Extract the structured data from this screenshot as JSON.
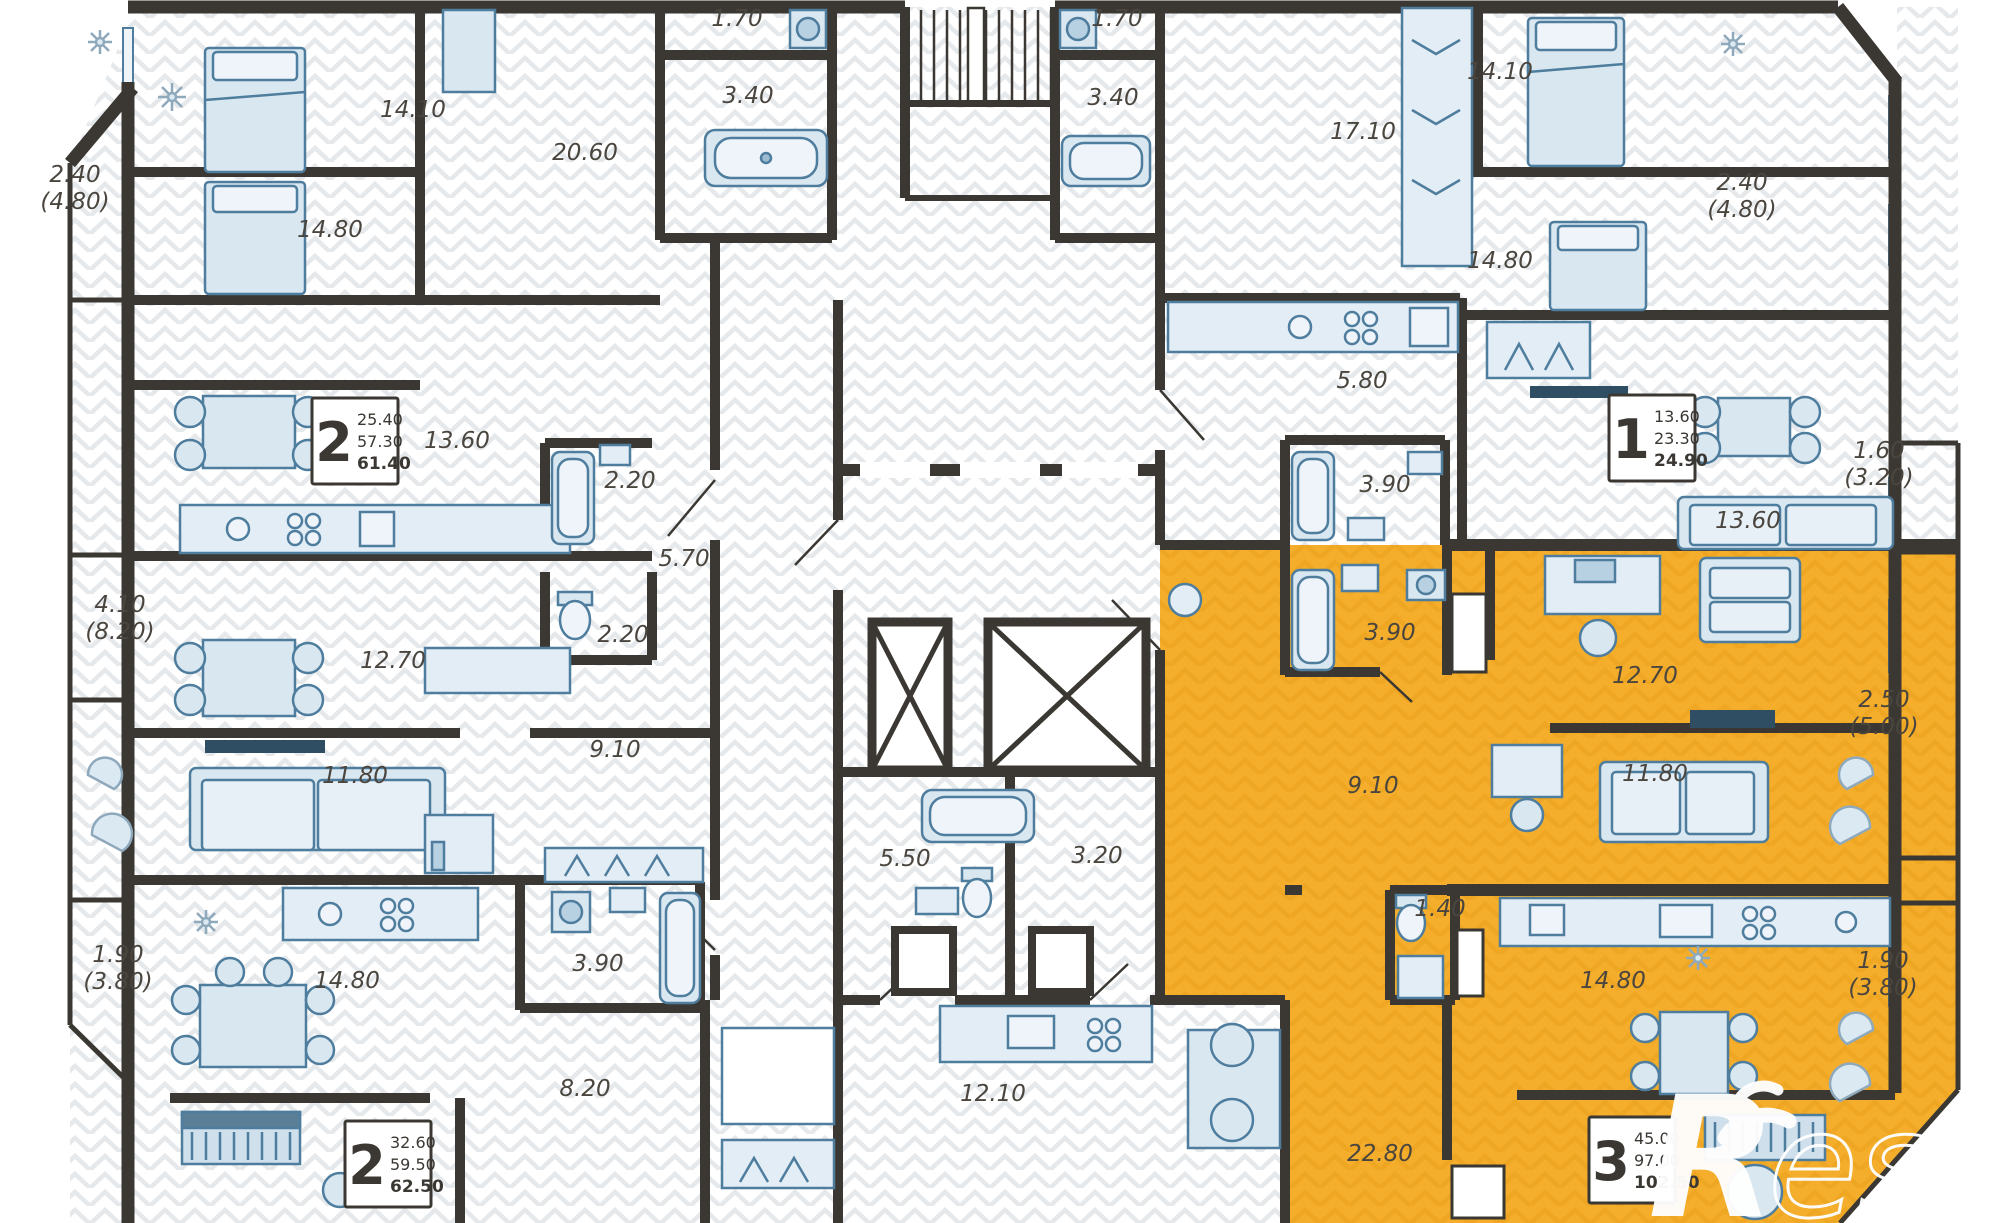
{
  "watermark": {
    "initial": "R",
    "rest": "estate"
  },
  "palette": {
    "wall": "#3b3833",
    "highlight": "#f5ae2b",
    "highlight_hatch": "#e89f1c",
    "hatch": "#e6e9ec",
    "furniture_fill": "#d9e7f1",
    "furniture_stroke": "#4f7d9e",
    "label": "#4a463f"
  },
  "apartments": [
    {
      "rooms": "2",
      "values": [
        "25.40",
        "57.30",
        "61.40"
      ],
      "x": 355,
      "y": 441,
      "highlighted": false
    },
    {
      "rooms": "1",
      "values": [
        "13.60",
        "23.30",
        "24.90"
      ],
      "x": 1652,
      "y": 438,
      "highlighted": false
    },
    {
      "rooms": "2",
      "values": [
        "32.60",
        "59.50",
        "62.50"
      ],
      "x": 388,
      "y": 1164,
      "highlighted": false
    },
    {
      "rooms": "3",
      "values": [
        "45.00",
        "97.00",
        "102.50"
      ],
      "x": 1632,
      "y": 1160,
      "highlighted": true
    }
  ],
  "room_labels": [
    {
      "t": "2.40",
      "s": "(4.80)",
      "x": 75,
      "y": 182
    },
    {
      "t": "14.10",
      "s": "",
      "x": 413,
      "y": 117
    },
    {
      "t": "20.60",
      "s": "",
      "x": 585,
      "y": 160
    },
    {
      "t": "1.70",
      "s": "",
      "x": 737,
      "y": 26
    },
    {
      "t": "3.40",
      "s": "",
      "x": 748,
      "y": 103
    },
    {
      "t": "1.70",
      "s": "",
      "x": 1117,
      "y": 26
    },
    {
      "t": "3.40",
      "s": "",
      "x": 1113,
      "y": 105
    },
    {
      "t": "17.10",
      "s": "",
      "x": 1363,
      "y": 139
    },
    {
      "t": "14.10",
      "s": "",
      "x": 1500,
      "y": 79
    },
    {
      "t": "2.40",
      "s": "(4.80)",
      "x": 1742,
      "y": 190
    },
    {
      "t": "14.80",
      "s": "",
      "x": 330,
      "y": 237
    },
    {
      "t": "14.80",
      "s": "",
      "x": 1500,
      "y": 268
    },
    {
      "t": "13.60",
      "s": "",
      "x": 457,
      "y": 448
    },
    {
      "t": "2.20",
      "s": "",
      "x": 630,
      "y": 488
    },
    {
      "t": "5.70",
      "s": "",
      "x": 684,
      "y": 566
    },
    {
      "t": "2.20",
      "s": "",
      "x": 623,
      "y": 642
    },
    {
      "t": "4.10",
      "s": "(8.20)",
      "x": 120,
      "y": 612
    },
    {
      "t": "12.70",
      "s": "",
      "x": 393,
      "y": 668
    },
    {
      "t": "11.80",
      "s": "",
      "x": 355,
      "y": 783
    },
    {
      "t": "9.10",
      "s": "",
      "x": 615,
      "y": 757
    },
    {
      "t": "1.90",
      "s": "(3.80)",
      "x": 118,
      "y": 962
    },
    {
      "t": "14.80",
      "s": "",
      "x": 347,
      "y": 988
    },
    {
      "t": "3.90",
      "s": "",
      "x": 598,
      "y": 971
    },
    {
      "t": "8.20",
      "s": "",
      "x": 585,
      "y": 1096
    },
    {
      "t": "5.50",
      "s": "",
      "x": 905,
      "y": 866
    },
    {
      "t": "3.20",
      "s": "",
      "x": 1097,
      "y": 863
    },
    {
      "t": "12.10",
      "s": "",
      "x": 993,
      "y": 1101
    },
    {
      "t": "5.80",
      "s": "",
      "x": 1362,
      "y": 388
    },
    {
      "t": "3.90",
      "s": "",
      "x": 1385,
      "y": 492
    },
    {
      "t": "13.60",
      "s": "",
      "x": 1748,
      "y": 528
    },
    {
      "t": "1.60",
      "s": "(3.20)",
      "x": 1879,
      "y": 458
    },
    {
      "t": "3.90",
      "s": "",
      "x": 1390,
      "y": 640
    },
    {
      "t": "12.70",
      "s": "",
      "x": 1645,
      "y": 683
    },
    {
      "t": "9.10",
      "s": "",
      "x": 1373,
      "y": 793
    },
    {
      "t": "11.80",
      "s": "",
      "x": 1655,
      "y": 781
    },
    {
      "t": "2.50",
      "s": "(5.00)",
      "x": 1884,
      "y": 707
    },
    {
      "t": "1.40",
      "s": "",
      "x": 1440,
      "y": 916
    },
    {
      "t": "14.80",
      "s": "",
      "x": 1613,
      "y": 988
    },
    {
      "t": "1.90",
      "s": "(3.80)",
      "x": 1883,
      "y": 968
    },
    {
      "t": "22.80",
      "s": "",
      "x": 1380,
      "y": 1161
    }
  ]
}
